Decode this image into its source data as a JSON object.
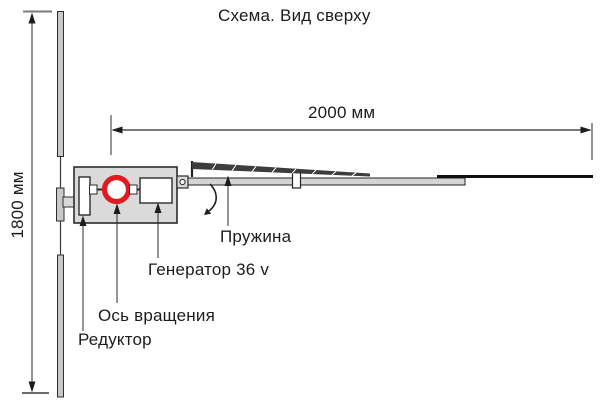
{
  "title": "Схема. Вид сверху",
  "dimensions": {
    "width_label": "2000 мм",
    "height_label": "1800 мм"
  },
  "labels": {
    "spring": "Пружина",
    "generator": "Генератор 36 v",
    "rotation_axis": "Ось вращения",
    "reducer": "Редуктор"
  },
  "colors": {
    "accent_red": "#e21b23",
    "line": "#2b2b2b",
    "fill_gray": "#d9d9d9",
    "blade_gray": "#c9c9c9",
    "background": "#ffffff"
  }
}
